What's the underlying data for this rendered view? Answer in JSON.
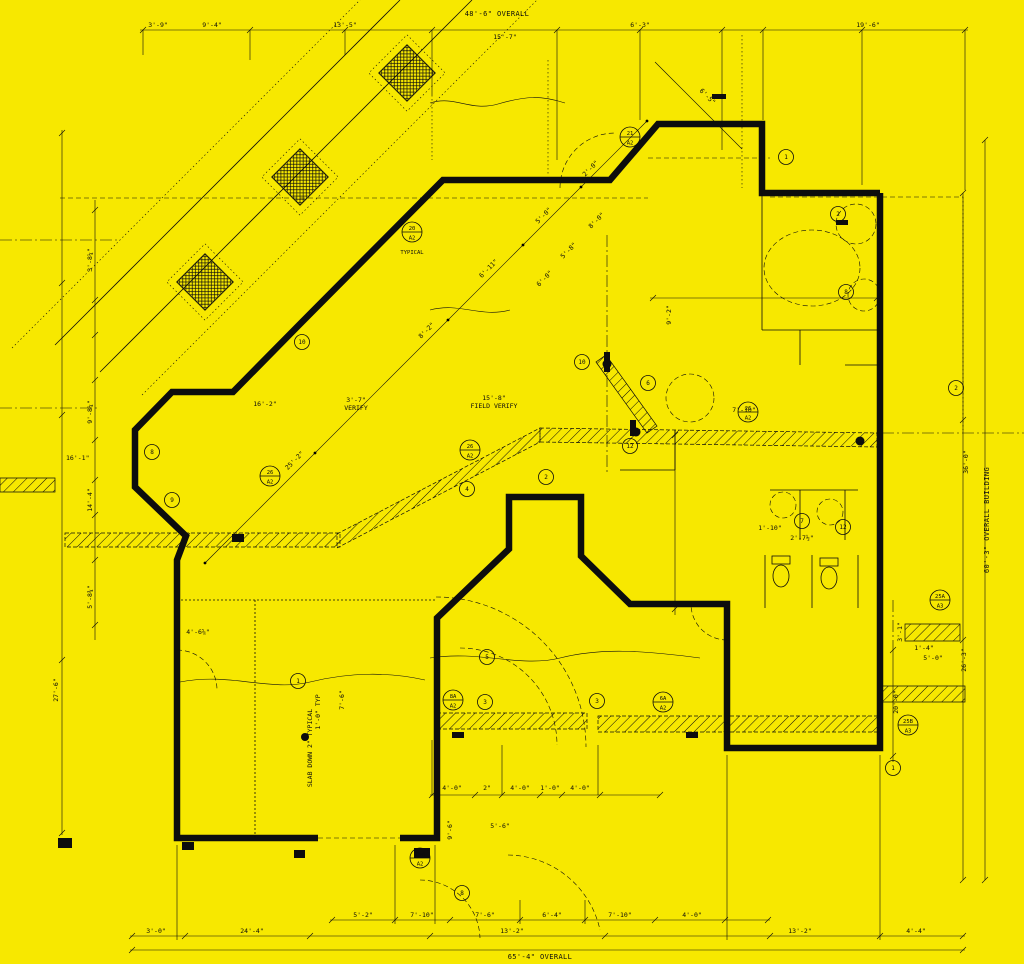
{
  "drawing": {
    "kind": "architectural floor plan (dimension/keynote sheet)",
    "background_color": "#F7E800",
    "ink_color": "#0d0d0d"
  },
  "top": {
    "overall": "48'-6\" OVERALL",
    "d1": "3'-9\"",
    "d2": "9'-4\"",
    "d3": "13'-5\"",
    "d4": "15'-7\"",
    "d5": "6'-3\"",
    "d6": "19'-6\""
  },
  "left": {
    "d1": "3'-8¼\"",
    "d2": "9'-8¼\"",
    "d3": "16'-1\"",
    "d4": "14'-4\"",
    "d5": "5'-8¾\"",
    "d6": "27'-6\""
  },
  "right": {
    "overall": "60'-3\" OVERALL BUILDING",
    "d1": "36'-0\"",
    "d2": "26'-3\"",
    "d3": "20'-0\"",
    "d4": "5'-0\"",
    "d5": "3'-1\"",
    "d6": "1'-4\""
  },
  "bottom": {
    "overall": "65'-4\" OVERALL",
    "d1": "3'-0\"",
    "d2": "24'-4\"",
    "d3": "13'-2\"",
    "d4": "13'-2\"",
    "d5": "4'-4\"",
    "c1": "5'-2\"",
    "c2": "7'-10\"",
    "c3": "7'-6\"",
    "c4": "6'-4\"",
    "c5": "7'-10\"",
    "c6": "4'-0\""
  },
  "wing": {
    "d1": "25'-2\"",
    "d2": "8'-2\"",
    "d3": "6'-11\"",
    "d4": "5'-0\"",
    "d5": "2'-0\"",
    "d6": "6'-5\"",
    "d7": "8'-0\"",
    "d8": "5'-8\"",
    "d9": "6'-0\""
  },
  "interior": {
    "a": "16'-2\"",
    "b1": "3'-7\"",
    "b2": "VERIFY",
    "c1": "15'-8\"",
    "c2": "FIELD VERIFY",
    "d": "7'-10\"",
    "e": "9'-2\"",
    "f": "2'-7½\"",
    "g": "1'-10\"",
    "h": "4'-6⅝\"",
    "i": "1'-0\" TYP",
    "j": "7'-6\"",
    "k": "5'-6\"",
    "l": "9'-6\"",
    "m1": "4'-0\"",
    "m2": "2\"",
    "m3": "4'-0\"",
    "m4": "1'-0\"",
    "m5": "4'-0\""
  },
  "notes": {
    "slab": "SLAB DOWN 2\" TYPICAL",
    "typical": "TYPICAL"
  },
  "keynotes": [
    {
      "n": "20",
      "s": "A2"
    },
    {
      "n": "26",
      "s": "A2"
    },
    {
      "n": "26",
      "s": "A2"
    },
    {
      "n": "21",
      "s": "A2"
    },
    {
      "n": "8A",
      "s": "A2"
    },
    {
      "n": "6A",
      "s": "A2"
    },
    {
      "n": "25A",
      "s": "A3"
    },
    {
      "n": "25B",
      "s": "A3"
    },
    {
      "n": "25A",
      "s": "A2"
    },
    {
      "n": "26",
      "s": "A2"
    }
  ],
  "bubbles": {
    "b1": "1",
    "b2": "2",
    "b3": "8",
    "b4": "10",
    "b5": "6",
    "b6": "12",
    "b7": "4",
    "b8": "7",
    "b9": "12",
    "b10": "3",
    "b11": "3",
    "b12": "10",
    "b13": "8",
    "b14": "9",
    "b15": "1",
    "b16": "5",
    "b17": "8",
    "b18": "2",
    "b19": "2",
    "b20": "1"
  }
}
